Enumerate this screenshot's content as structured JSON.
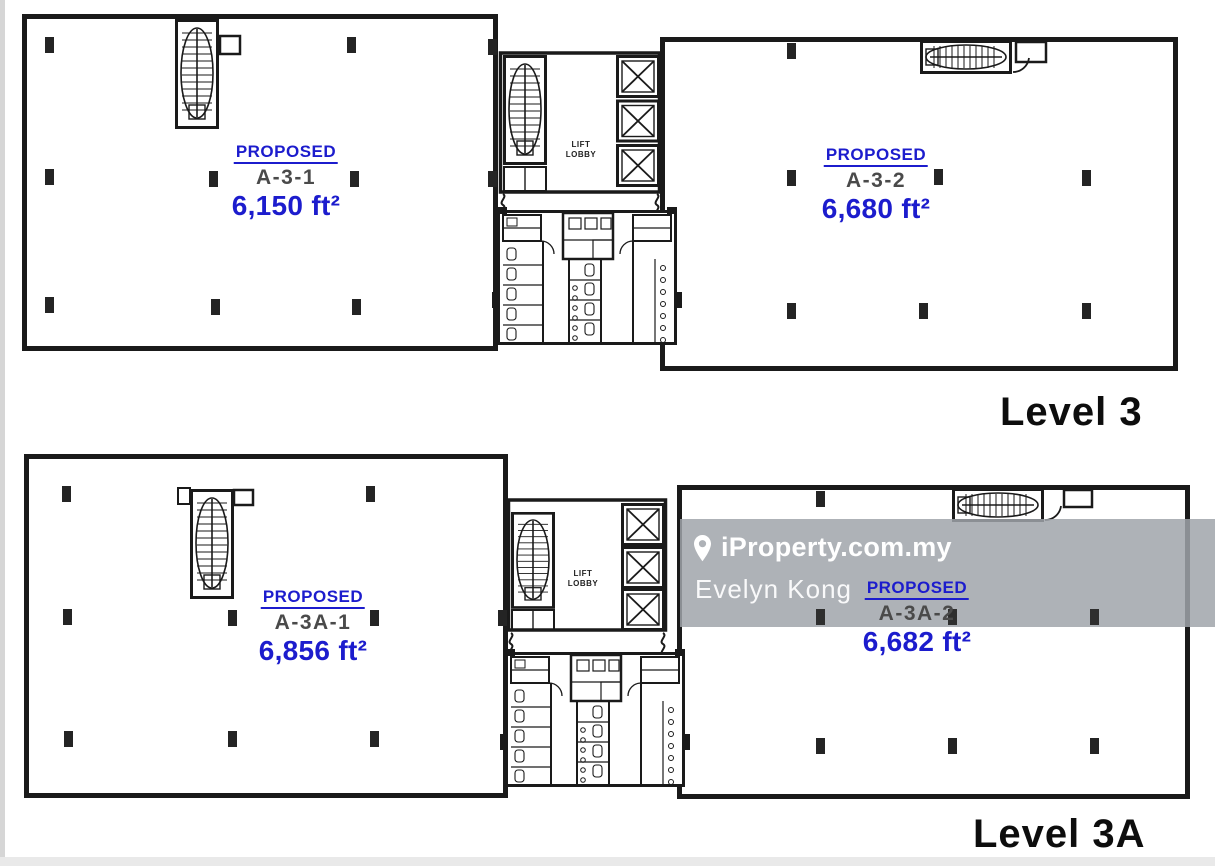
{
  "plans": [
    {
      "level_label": "Level 3",
      "core": {
        "lift_lobby": [
          "LIFT",
          "LOBBY"
        ]
      },
      "units": [
        {
          "status": "PROPOSED",
          "name": "A-3-1",
          "area": "6,150 ft²"
        },
        {
          "status": "PROPOSED",
          "name": "A-3-2",
          "area": "6,680 ft²"
        }
      ]
    },
    {
      "level_label": "Level 3A",
      "core": {
        "lift_lobby": [
          "LIFT",
          "LOBBY"
        ]
      },
      "units": [
        {
          "status": "PROPOSED",
          "name": "A-3A-1",
          "area": "6,856 ft²"
        },
        {
          "status": "PROPOSED",
          "name": "A-3A-2",
          "area": "6,682 ft²"
        }
      ]
    }
  ],
  "watermark": {
    "brand": "iProperty.com.my",
    "agent": "Evelyn Kong"
  },
  "colors": {
    "wall": "#1a1a1a",
    "accent_blue": "#1c1ccd",
    "unit_name_gray": "#4a4a4a",
    "watermark_band": "rgba(160,165,170,0.85)",
    "watermark_text": "#ffffff"
  }
}
